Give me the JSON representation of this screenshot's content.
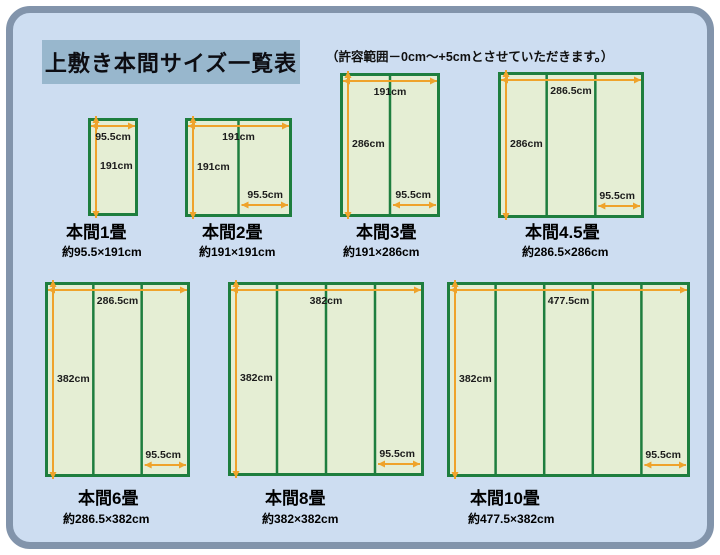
{
  "header": {
    "title": "上敷き本間サイズ一覧表",
    "note": "（許容範囲－0cm～+5cmとさせていただきます。）"
  },
  "colors": {
    "page_background": "#ffffff",
    "panel_background": "#cdddf1",
    "frame_border": "#8294ab",
    "title_box_background": "#98b7cd",
    "mat_fill": "#e5eed4",
    "mat_border": "#1e7e3e",
    "arrow": "#efa32b",
    "text": "#000000"
  },
  "diagrams": [
    {
      "id": "honma-1jo",
      "name": "本間1畳",
      "size_caption": "約95.5×191cm",
      "width_cm": 95.5,
      "height_cm": 191,
      "panels": 1,
      "width_label": "95.5cm",
      "height_label": "191cm",
      "panel_label": null
    },
    {
      "id": "honma-2jo",
      "name": "本間2畳",
      "size_caption": "約191×191cm",
      "width_cm": 191,
      "height_cm": 191,
      "panels": 2,
      "width_label": "191cm",
      "height_label": "191cm",
      "panel_label": "95.5cm"
    },
    {
      "id": "honma-3jo",
      "name": "本間3畳",
      "size_caption": "約191×286cm",
      "width_cm": 191,
      "height_cm": 286,
      "panels": 2,
      "width_label": "191cm",
      "height_label": "286cm",
      "panel_label": "95.5cm"
    },
    {
      "id": "honma-4-5jo",
      "name": "本間4.5畳",
      "size_caption": "約286.5×286cm",
      "width_cm": 286.5,
      "height_cm": 286,
      "panels": 3,
      "width_label": "286.5cm",
      "height_label": "286cm",
      "panel_label": "95.5cm"
    },
    {
      "id": "honma-6jo",
      "name": "本間6畳",
      "size_caption": "約286.5×382cm",
      "width_cm": 286.5,
      "height_cm": 382,
      "panels": 3,
      "width_label": "286.5cm",
      "height_label": "382cm",
      "panel_label": "95.5cm"
    },
    {
      "id": "honma-8jo",
      "name": "本間8畳",
      "size_caption": "約382×382cm",
      "width_cm": 382,
      "height_cm": 382,
      "panels": 4,
      "width_label": "382cm",
      "height_label": "382cm",
      "panel_label": "95.5cm"
    },
    {
      "id": "honma-10jo",
      "name": "本間10畳",
      "size_caption": "約477.5×382cm",
      "width_cm": 477.5,
      "height_cm": 382,
      "panels": 5,
      "width_label": "477.5cm",
      "height_label": "382cm",
      "panel_label": "95.5cm"
    }
  ]
}
